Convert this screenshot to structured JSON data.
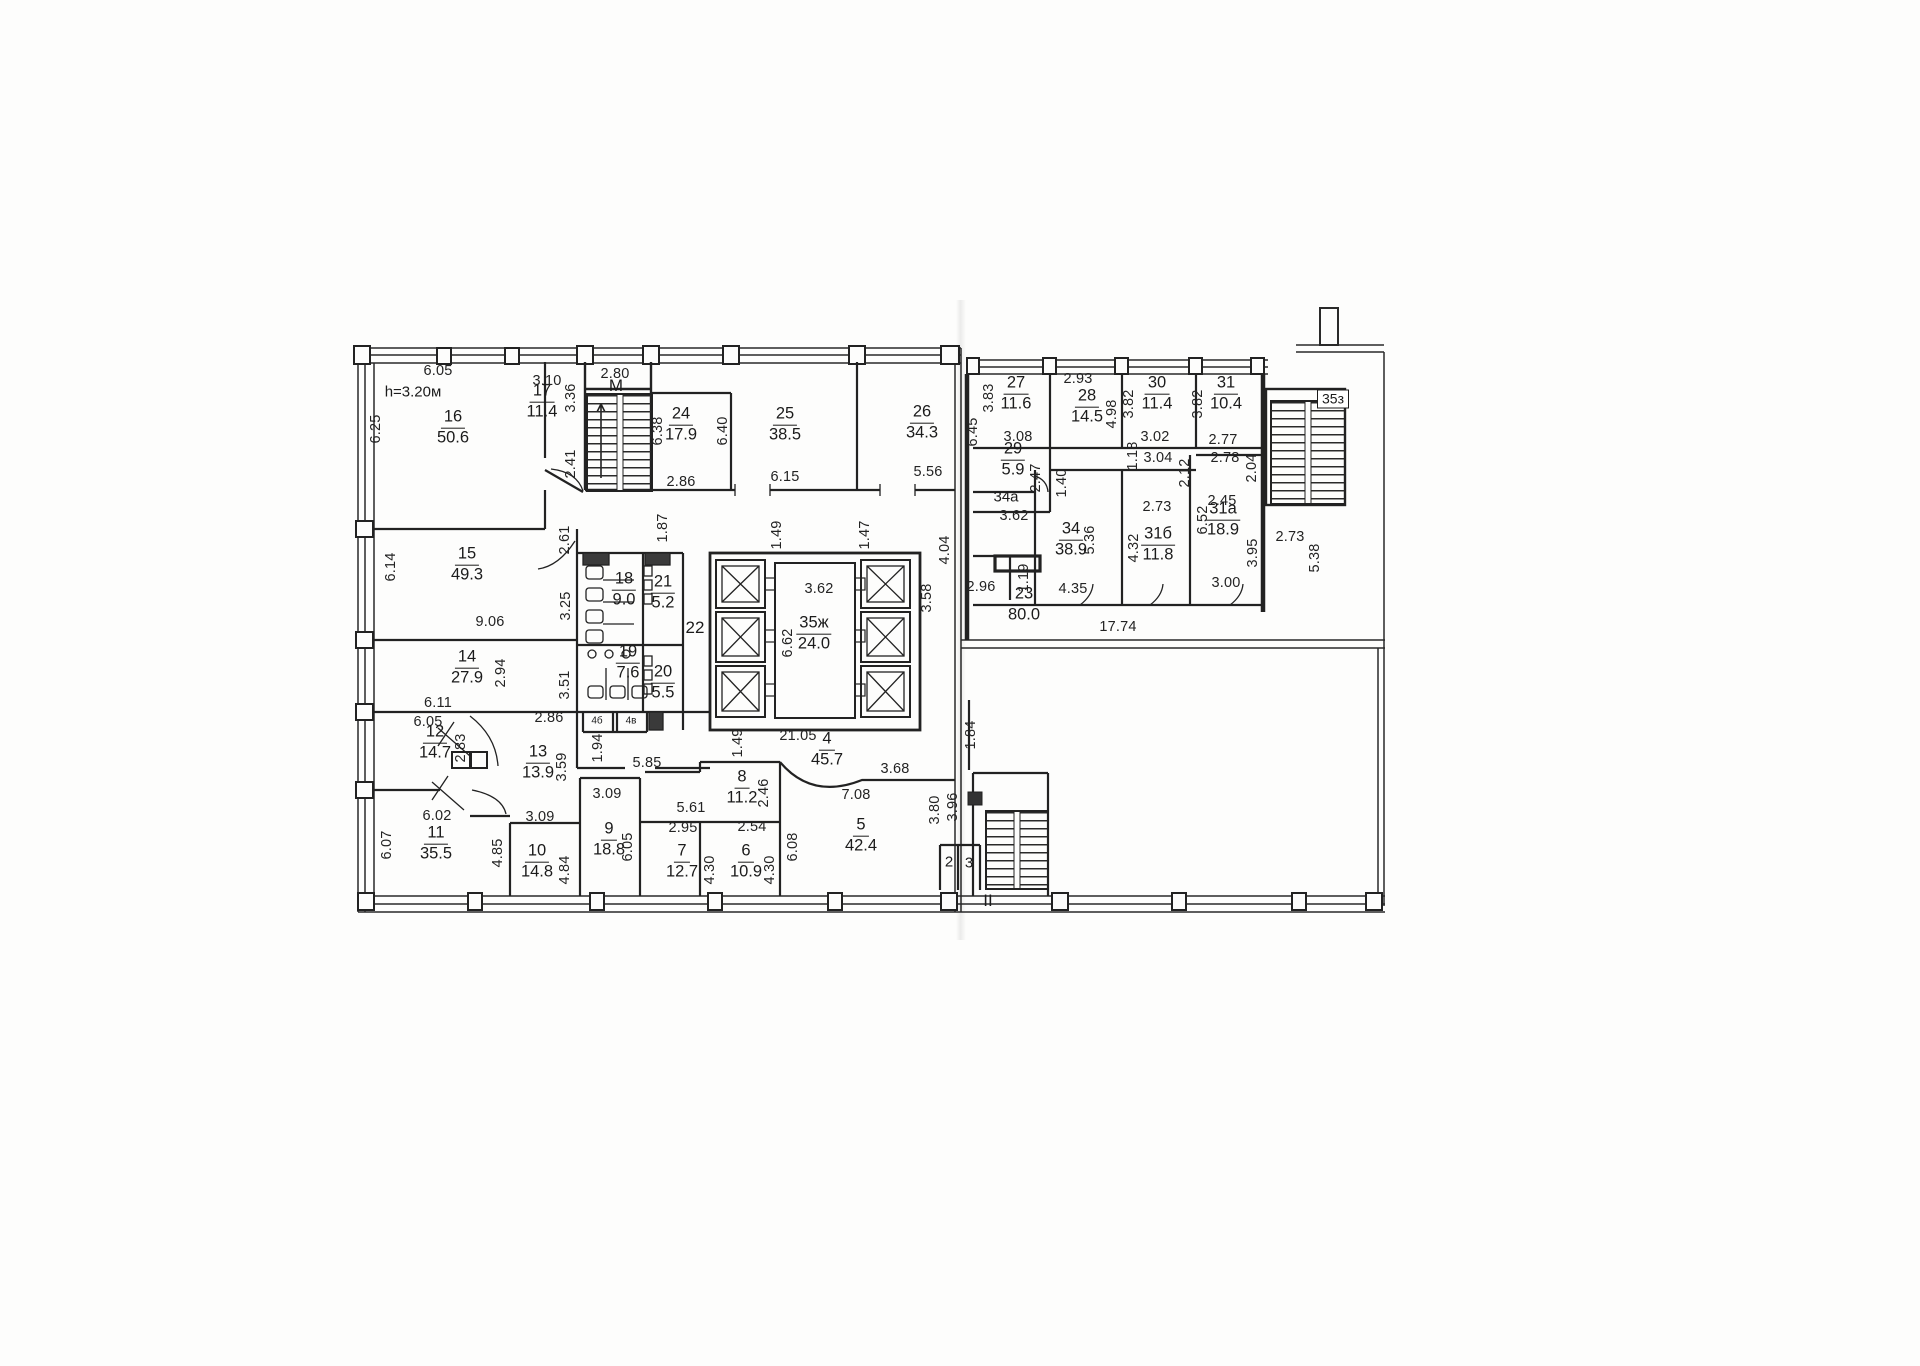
{
  "document": {
    "type": "scanned floor plan",
    "height_note": "h=3.20м",
    "ink_color": "#1f1f1f",
    "paper_color": "#fdfdfc"
  },
  "rooms": [
    {
      "number": "16",
      "area": "50.6",
      "x": 453,
      "y": 428
    },
    {
      "number": "17",
      "area": "11.4",
      "x": 542,
      "y": 402
    },
    {
      "number": "24",
      "area": "17.9",
      "x": 681,
      "y": 425
    },
    {
      "number": "25",
      "area": "38.5",
      "x": 785,
      "y": 425
    },
    {
      "number": "26",
      "area": "34.3",
      "x": 922,
      "y": 423
    },
    {
      "number": "27",
      "area": "11.6",
      "x": 1016,
      "y": 394
    },
    {
      "number": "28",
      "area": "14.5",
      "x": 1087,
      "y": 407
    },
    {
      "number": "30",
      "area": "11.4",
      "x": 1157,
      "y": 394
    },
    {
      "number": "31",
      "area": "10.4",
      "x": 1226,
      "y": 394
    },
    {
      "number": "29",
      "area": "5.9",
      "x": 1013,
      "y": 460
    },
    {
      "number": "34",
      "area": "38.9",
      "x": 1071,
      "y": 540
    },
    {
      "number": "31б",
      "area": "11.8",
      "x": 1158,
      "y": 545
    },
    {
      "number": "31а",
      "area": "18.9",
      "x": 1223,
      "y": 520
    },
    {
      "number": "23",
      "area": "80.0",
      "x": 1024,
      "y": 605
    },
    {
      "number": "35ж",
      "area": "24.0",
      "x": 814,
      "y": 634
    },
    {
      "number": "18",
      "area": "9.0",
      "x": 624,
      "y": 590
    },
    {
      "number": "21",
      "area": "5.2",
      "x": 663,
      "y": 593
    },
    {
      "number": "19",
      "area": "7.6",
      "x": 628,
      "y": 663
    },
    {
      "number": "20",
      "area": "5.5",
      "x": 663,
      "y": 683
    },
    {
      "number": "15",
      "area": "49.3",
      "x": 467,
      "y": 565
    },
    {
      "number": "14",
      "area": "27.9",
      "x": 467,
      "y": 668
    },
    {
      "number": "12",
      "area": "14.7",
      "x": 435,
      "y": 743
    },
    {
      "number": "13",
      "area": "13.9",
      "x": 538,
      "y": 763
    },
    {
      "number": "11",
      "area": "35.5",
      "x": 436,
      "y": 844
    },
    {
      "number": "10",
      "area": "14.8",
      "x": 537,
      "y": 862
    },
    {
      "number": "9",
      "area": "18.8",
      "x": 609,
      "y": 840
    },
    {
      "number": "7",
      "area": "12.7",
      "x": 682,
      "y": 862
    },
    {
      "number": "6",
      "area": "10.9",
      "x": 746,
      "y": 862
    },
    {
      "number": "8",
      "area": "11.2",
      "x": 742,
      "y": 788
    },
    {
      "number": "5",
      "area": "42.4",
      "x": 861,
      "y": 836
    },
    {
      "number": "4",
      "area": "45.7",
      "x": 827,
      "y": 750
    }
  ],
  "dimensions": [
    {
      "text": "6.05",
      "x": 438,
      "y": 371,
      "v": false
    },
    {
      "text": "3.10",
      "x": 547,
      "y": 381,
      "v": false
    },
    {
      "text": "2.80",
      "x": 615,
      "y": 374,
      "v": false
    },
    {
      "text": "2.93",
      "x": 1078,
      "y": 379,
      "v": false
    },
    {
      "text": "3.08",
      "x": 1018,
      "y": 437,
      "v": false
    },
    {
      "text": "3.02",
      "x": 1155,
      "y": 437,
      "v": false
    },
    {
      "text": "2.77",
      "x": 1223,
      "y": 440,
      "v": false
    },
    {
      "text": "3.04",
      "x": 1158,
      "y": 458,
      "v": false
    },
    {
      "text": "2.78",
      "x": 1225,
      "y": 458,
      "v": false
    },
    {
      "text": "2.86",
      "x": 681,
      "y": 482,
      "v": false
    },
    {
      "text": "6.15",
      "x": 785,
      "y": 477,
      "v": false
    },
    {
      "text": "5.56",
      "x": 928,
      "y": 472,
      "v": false
    },
    {
      "text": "3.62",
      "x": 1014,
      "y": 516,
      "v": false
    },
    {
      "text": "2.45",
      "x": 1222,
      "y": 501,
      "v": false
    },
    {
      "text": "2.73",
      "x": 1157,
      "y": 507,
      "v": false
    },
    {
      "text": "2.73",
      "x": 1290,
      "y": 537,
      "v": false
    },
    {
      "text": "3.00",
      "x": 1226,
      "y": 583,
      "v": false
    },
    {
      "text": "4.35",
      "x": 1073,
      "y": 589,
      "v": false
    },
    {
      "text": "2.96",
      "x": 981,
      "y": 587,
      "v": false
    },
    {
      "text": "17.74",
      "x": 1118,
      "y": 627,
      "v": false
    },
    {
      "text": "3.62",
      "x": 819,
      "y": 589,
      "v": false
    },
    {
      "text": "9.06",
      "x": 490,
      "y": 622,
      "v": false
    },
    {
      "text": "6.11",
      "x": 438,
      "y": 703,
      "v": false
    },
    {
      "text": "2.86",
      "x": 549,
      "y": 718,
      "v": false
    },
    {
      "text": "6.05",
      "x": 428,
      "y": 722,
      "v": false
    },
    {
      "text": "3.09",
      "x": 607,
      "y": 794,
      "v": false
    },
    {
      "text": "3.09",
      "x": 540,
      "y": 817,
      "v": false
    },
    {
      "text": "6.02",
      "x": 437,
      "y": 816,
      "v": false
    },
    {
      "text": "5.85",
      "x": 647,
      "y": 763,
      "v": false
    },
    {
      "text": "5.61",
      "x": 691,
      "y": 808,
      "v": false
    },
    {
      "text": "2.95",
      "x": 683,
      "y": 828,
      "v": false
    },
    {
      "text": "2.54",
      "x": 752,
      "y": 827,
      "v": false
    },
    {
      "text": "7.08",
      "x": 856,
      "y": 795,
      "v": false
    },
    {
      "text": "3.68",
      "x": 895,
      "y": 769,
      "v": false
    },
    {
      "text": "21.05",
      "x": 798,
      "y": 736,
      "v": false
    },
    {
      "text": "6.25",
      "x": 376,
      "y": 429,
      "v": true
    },
    {
      "text": "3.36",
      "x": 571,
      "y": 398,
      "v": true
    },
    {
      "text": "2.41",
      "x": 571,
      "y": 464,
      "v": true
    },
    {
      "text": "6.38",
      "x": 658,
      "y": 431,
      "v": true
    },
    {
      "text": "6.40",
      "x": 723,
      "y": 431,
      "v": true
    },
    {
      "text": "6.45",
      "x": 973,
      "y": 432,
      "v": true
    },
    {
      "text": "3.83",
      "x": 989,
      "y": 398,
      "v": true
    },
    {
      "text": "4.98",
      "x": 1112,
      "y": 414,
      "v": true
    },
    {
      "text": "3.82",
      "x": 1129,
      "y": 404,
      "v": true
    },
    {
      "text": "3.82",
      "x": 1198,
      "y": 404,
      "v": true
    },
    {
      "text": "1.18",
      "x": 1133,
      "y": 456,
      "v": true
    },
    {
      "text": "2.12",
      "x": 1185,
      "y": 473,
      "v": true
    },
    {
      "text": "2.04",
      "x": 1252,
      "y": 468,
      "v": true
    },
    {
      "text": "2.47",
      "x": 1036,
      "y": 478,
      "v": true
    },
    {
      "text": "1.40",
      "x": 1062,
      "y": 483,
      "v": true
    },
    {
      "text": "5.36",
      "x": 1090,
      "y": 540,
      "v": true
    },
    {
      "text": "4.32",
      "x": 1134,
      "y": 548,
      "v": true
    },
    {
      "text": "1.19",
      "x": 1024,
      "y": 578,
      "v": true
    },
    {
      "text": "6.52",
      "x": 1203,
      "y": 520,
      "v": true
    },
    {
      "text": "3.95",
      "x": 1253,
      "y": 553,
      "v": true
    },
    {
      "text": "5.38",
      "x": 1315,
      "y": 558,
      "v": true
    },
    {
      "text": "1.49",
      "x": 777,
      "y": 535,
      "v": true
    },
    {
      "text": "1.47",
      "x": 865,
      "y": 535,
      "v": true
    },
    {
      "text": "4.04",
      "x": 945,
      "y": 550,
      "v": true
    },
    {
      "text": "6.62",
      "x": 788,
      "y": 643,
      "v": true
    },
    {
      "text": "3.58",
      "x": 927,
      "y": 598,
      "v": true
    },
    {
      "text": "1.87",
      "x": 663,
      "y": 528,
      "v": true
    },
    {
      "text": "2.61",
      "x": 565,
      "y": 540,
      "v": true
    },
    {
      "text": "3.25",
      "x": 566,
      "y": 606,
      "v": true
    },
    {
      "text": "3.51",
      "x": 565,
      "y": 685,
      "v": true
    },
    {
      "text": "1.94",
      "x": 598,
      "y": 748,
      "v": true
    },
    {
      "text": "6.14",
      "x": 391,
      "y": 567,
      "v": true
    },
    {
      "text": "2.94",
      "x": 501,
      "y": 673,
      "v": true
    },
    {
      "text": "2.83",
      "x": 461,
      "y": 748,
      "v": true
    },
    {
      "text": "3.59",
      "x": 562,
      "y": 767,
      "v": true
    },
    {
      "text": "6.07",
      "x": 387,
      "y": 845,
      "v": true
    },
    {
      "text": "4.85",
      "x": 498,
      "y": 853,
      "v": true
    },
    {
      "text": "4.84",
      "x": 565,
      "y": 870,
      "v": true
    },
    {
      "text": "6.05",
      "x": 628,
      "y": 847,
      "v": true
    },
    {
      "text": "2.46",
      "x": 764,
      "y": 793,
      "v": true
    },
    {
      "text": "4.30",
      "x": 710,
      "y": 870,
      "v": true
    },
    {
      "text": "4.30",
      "x": 770,
      "y": 870,
      "v": true
    },
    {
      "text": "6.08",
      "x": 793,
      "y": 847,
      "v": true
    },
    {
      "text": "3.80",
      "x": 935,
      "y": 810,
      "v": true
    },
    {
      "text": "3.96",
      "x": 953,
      "y": 807,
      "v": true
    },
    {
      "text": "1.84",
      "x": 971,
      "y": 735,
      "v": true
    },
    {
      "text": "1.49",
      "x": 738,
      "y": 743,
      "v": true
    }
  ],
  "annotations": [
    {
      "text": "h=3.20м",
      "x": 413,
      "y": 392,
      "style": "plain"
    },
    {
      "text": "М",
      "x": 616,
      "y": 386,
      "style": "big"
    },
    {
      "text": "22",
      "x": 695,
      "y": 628,
      "style": "big"
    },
    {
      "text": "34а",
      "x": 1006,
      "y": 497,
      "style": "plain"
    },
    {
      "text": "35з",
      "x": 1333,
      "y": 399,
      "style": "boxed"
    },
    {
      "text": "II",
      "x": 988,
      "y": 901,
      "style": "big"
    },
    {
      "text": "2",
      "x": 949,
      "y": 862,
      "style": "plain"
    },
    {
      "text": "3",
      "x": 969,
      "y": 863,
      "style": "plain"
    },
    {
      "text": "4б",
      "x": 597,
      "y": 721,
      "style": "tiny"
    },
    {
      "text": "4в",
      "x": 631,
      "y": 721,
      "style": "tiny"
    }
  ]
}
